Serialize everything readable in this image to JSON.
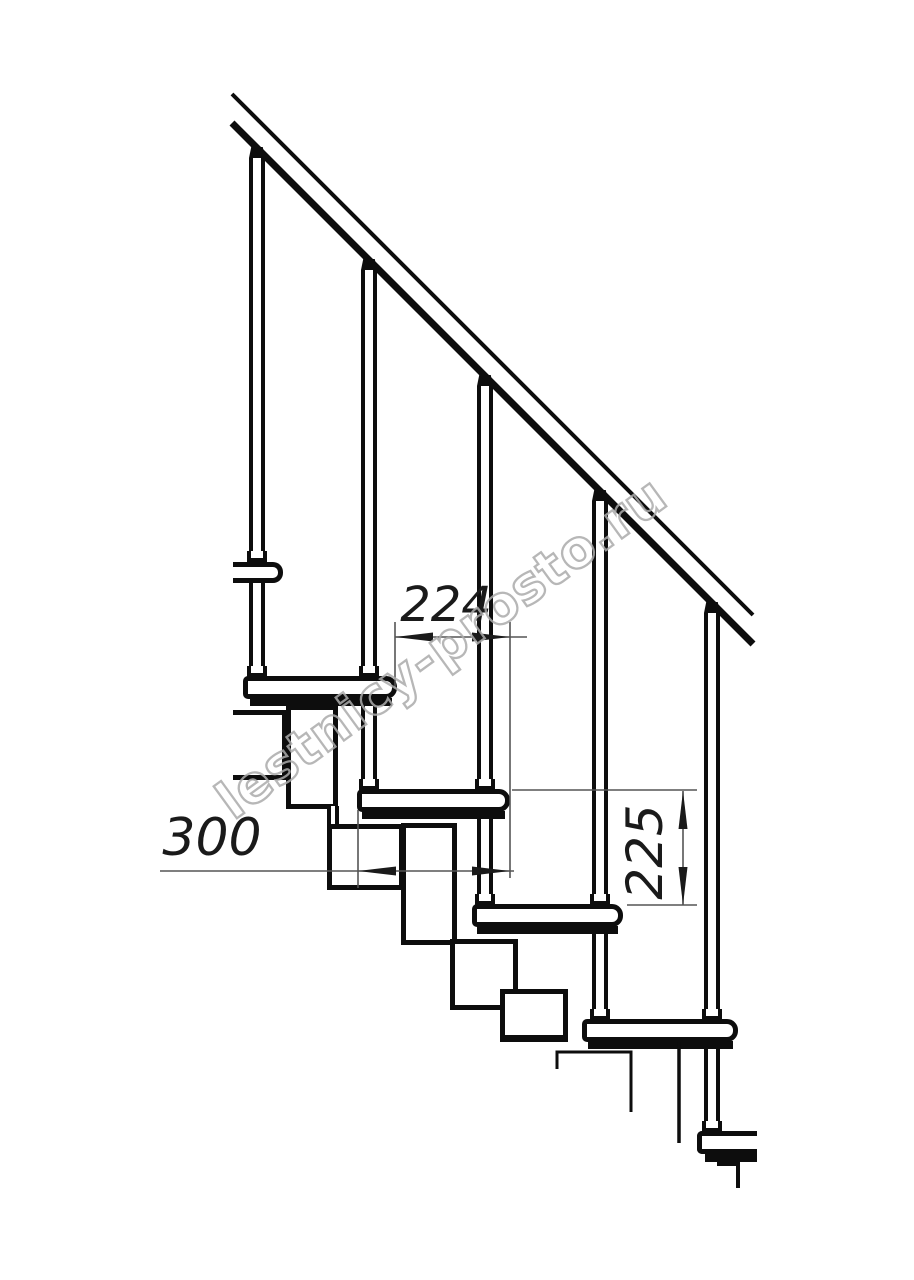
{
  "drawing": {
    "dimensions": {
      "step_run_label": "224",
      "tread_depth_label": "300",
      "riser_height_label": "225"
    },
    "watermark": {
      "text": "lestnicy-prosto.ru"
    },
    "colors": {
      "line": "#0d0d0d",
      "dimension_line": "#555555",
      "dimension_text": "#1a1a1a",
      "watermark": "#ababab",
      "background": "#ffffff"
    }
  }
}
